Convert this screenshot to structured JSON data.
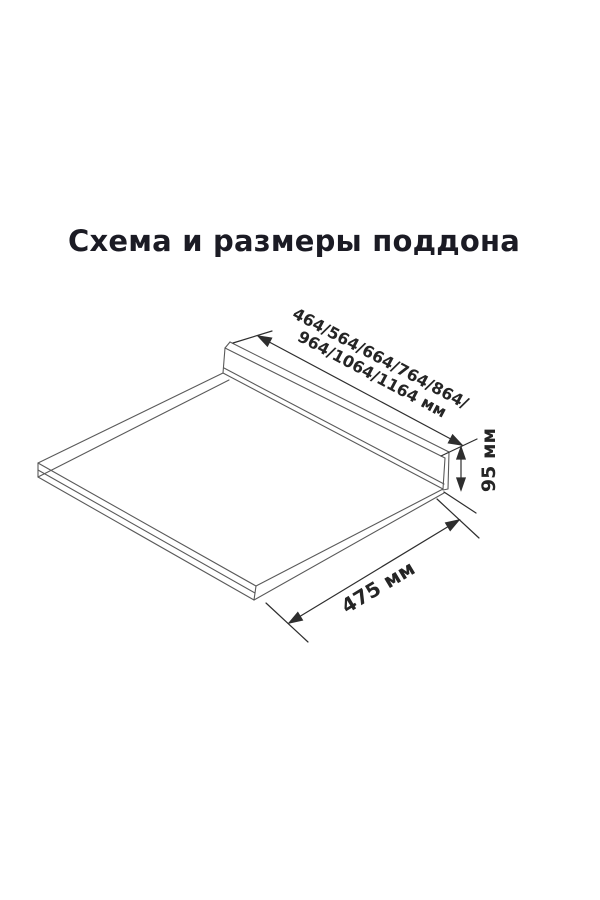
{
  "title": {
    "text": "Схема и размеры поддона"
  },
  "diagram": {
    "subject": "pallet-isometric-drawing",
    "labels": {
      "width_line1": "464/564/664/764/864/",
      "width_line2": "964/1064/1164 мм",
      "height": "95 мм",
      "depth": "475 мм"
    }
  },
  "colors": {
    "page-bg": "#ffffff",
    "title-color": "#1b1b24",
    "line-color": "#5a5a5a",
    "dim-color": "#2e2e2e",
    "label-color": "#252525"
  }
}
